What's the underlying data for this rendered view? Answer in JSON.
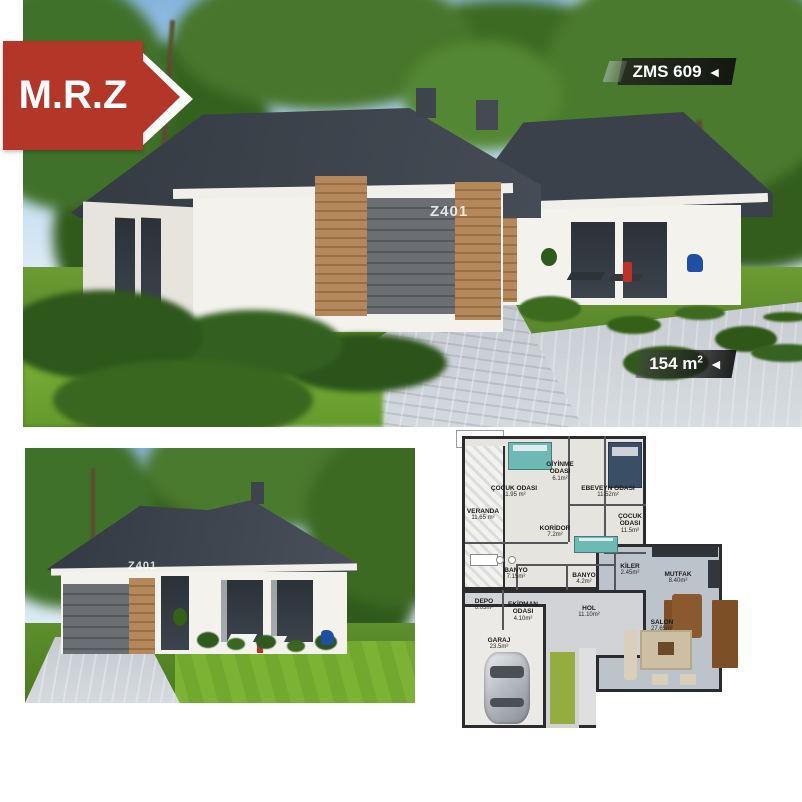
{
  "colors": {
    "brand_red": "#b33628",
    "tag_background": "#14130f",
    "plan_green": "#95ad3f",
    "roof_dark": "#3a4149"
  },
  "brand_badge": {
    "text": "M.R.Z"
  },
  "model_tag": {
    "text": "ZMS 609",
    "arrow": "◄"
  },
  "area_tag": {
    "value": "154 m",
    "sup": "2",
    "arrow": "◄"
  },
  "watermarks": {
    "top_photo": "Z401",
    "bottom_photo": "Z401"
  },
  "floorplan": {
    "rooms": [
      {
        "name": "VERANDA",
        "area": "11.65 m²"
      },
      {
        "name": "ÇOCUK ODASI",
        "area": "11.95 m²"
      },
      {
        "name": "GİYİNME ODASI",
        "area": "6.1m²"
      },
      {
        "name": "EBEVEYN ODASI",
        "area": "11.52m²"
      },
      {
        "name": "ÇOCUK ODASI",
        "area": "11.5m²"
      },
      {
        "name": "KORİDOR",
        "area": "7.2m²"
      },
      {
        "name": "BANYO",
        "area": "7.15m²"
      },
      {
        "name": "BANYO",
        "area": "4.2m²"
      },
      {
        "name": "KİLER",
        "area": "2.45m²"
      },
      {
        "name": "MUTFAK",
        "area": "8.40m²"
      },
      {
        "name": "DEPO",
        "area": "6.05m²"
      },
      {
        "name": "EKİPMAN ODASI",
        "area": "4.10m²"
      },
      {
        "name": "HOL",
        "area": "11.10m²"
      },
      {
        "name": "SALON",
        "area": "27.65m²"
      },
      {
        "name": "GARAJ",
        "area": "23.5m²"
      }
    ]
  }
}
